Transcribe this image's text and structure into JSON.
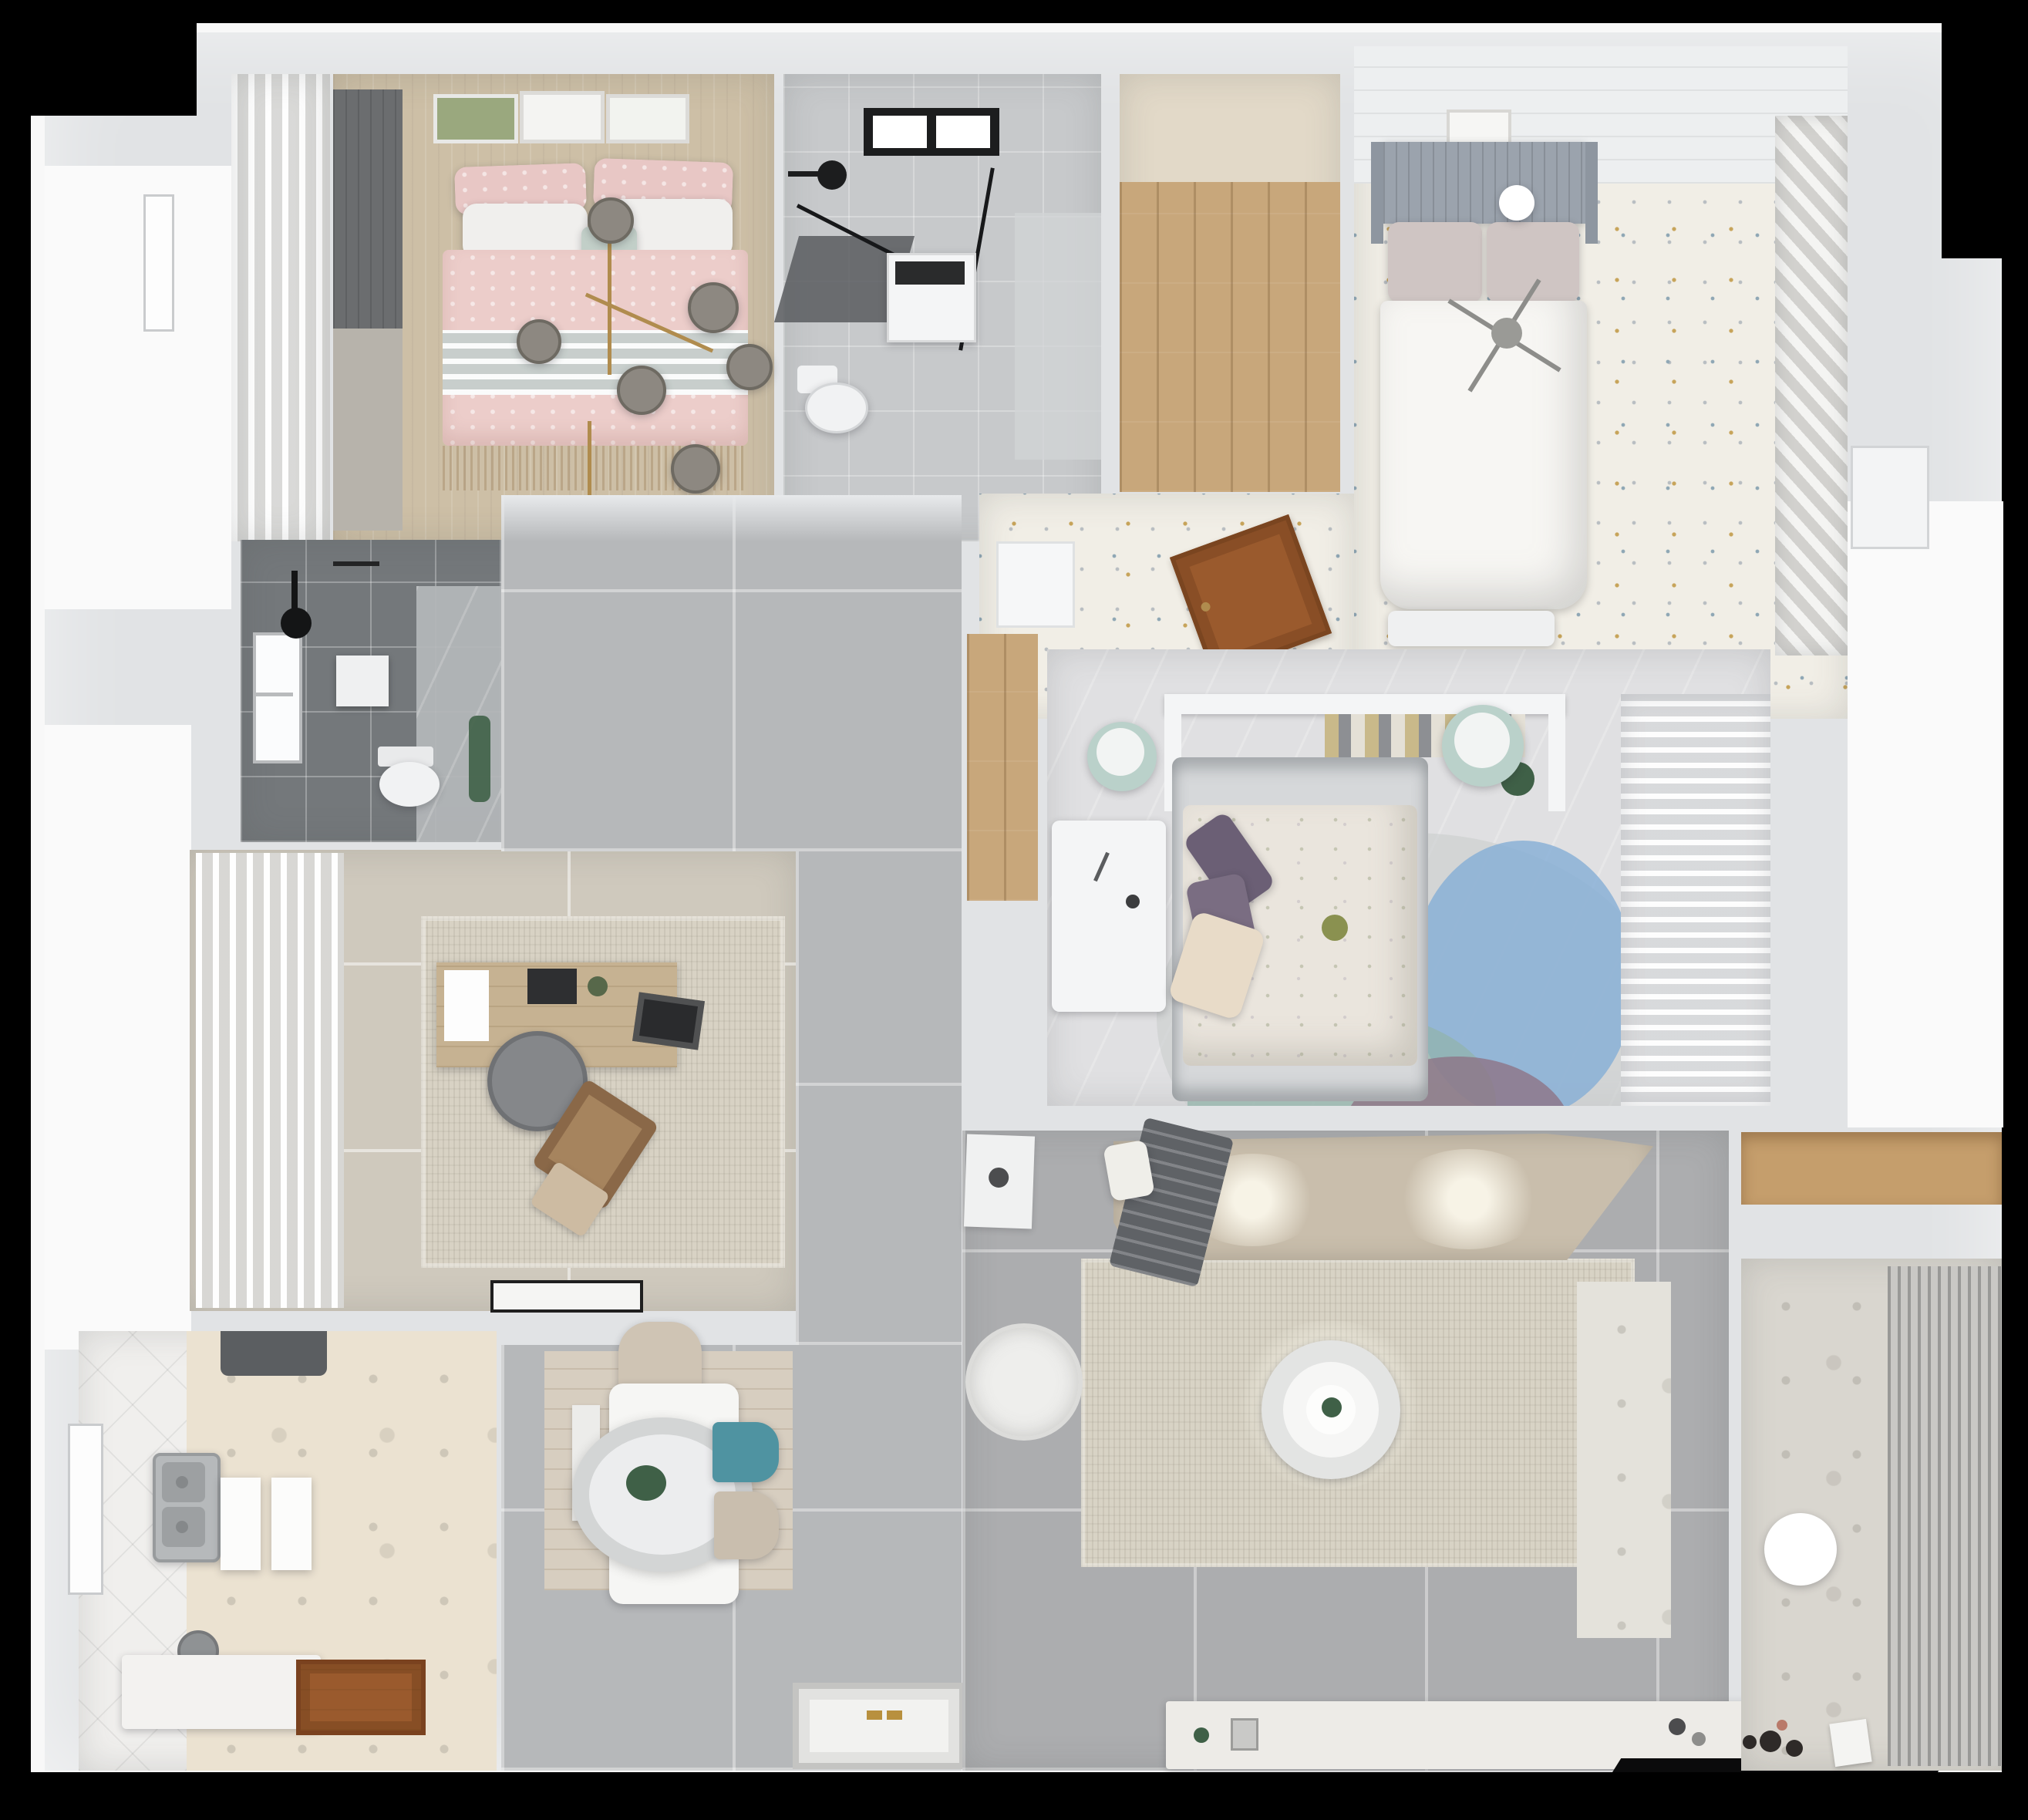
{
  "meta": {
    "type": "3d-floor-plan-render",
    "view": "top-down-apartment",
    "visible_text": "none"
  },
  "palette": {
    "background": "#000000",
    "canvas": "#f8f8f8",
    "wall": "#e1e3e5",
    "wall_dark": "#d2d4d6",
    "exterior_white": "#fafafa"
  },
  "rooms": {
    "bedroom2": {
      "name": "Bedroom with pink bed",
      "floor": "#cdbfa6"
    },
    "balcony_left": {
      "name": "Side ledge with curtains",
      "floor": "#e7e8e9"
    },
    "bathroom1": {
      "name": "Bathroom with glass shower",
      "floor": "#c7c9cb"
    },
    "closet": {
      "name": "Walk-through closet",
      "floor": "#c8a77b",
      "upper": "#e2d9c8"
    },
    "bedroom1": {
      "name": "Bedroom with white bed",
      "floor": "#f1eee6",
      "ceiling": "#edeff0",
      "wardrobe": "#e6e6e4"
    },
    "bathroom2": {
      "name": "Dark shower room",
      "floor": "#74787b",
      "marble": "#b5b8ba"
    },
    "study": {
      "name": "Study",
      "floor": "#cfc9bd",
      "curtain": "#e3e3e2"
    },
    "kitchen": {
      "name": "Kitchen / laundry",
      "floor": "#ebe2d1",
      "counter_zone": "#f0efed"
    },
    "hallway": {
      "name": "Hallway",
      "floor": "#b6b8ba"
    },
    "dining": {
      "name": "Dining area",
      "floor": "#b6b8ba",
      "wood_mat": "#d7cec0"
    },
    "master": {
      "name": "Master bedroom",
      "floor": "#e0e0e2",
      "nook_wood": "#c8a77b",
      "sheer": "#e4e5e7"
    },
    "living": {
      "name": "Living room",
      "floor": "#acadaf",
      "accent_strip": "#e4e2db"
    },
    "balcony": {
      "name": "Balcony with blinds",
      "floor": "#d9d6cf",
      "blinds": "#b5b4b1"
    },
    "storage": {
      "name": "Storage niche",
      "wood": "#c59e6c"
    }
  },
  "furniture": {
    "bed_pink_duvet": "#eccdca",
    "bed_pink_pillow": "#e8c7c5",
    "bed_white_pillow": "#f0efed",
    "bed_mint_band": "#c2cfc8",
    "chandelier_globe": "#8d8881",
    "chandelier_gold": "#b08c4e",
    "frame_art": "#9aa87e",
    "curtain_dark": "#6b6d6f",
    "shower_black": "#1c1d1e",
    "shower_tray": "#595c5f",
    "washer": "#f4f5f6",
    "toilet": "#f1f2f3",
    "headboard_gray": "#9ba3ad",
    "bed1_pillow": "#cfc5c3",
    "bed1_duvet": "#f7f6f3",
    "door_wood": "#9a5a2d",
    "plant_green": "#3f6047",
    "desk_wood": "#c6b292",
    "office_chair": "#85878a",
    "lounge_chair": "#8a6848",
    "monitor": "#2a2b2d",
    "rug_study": "#d8d2c4",
    "hood_dark": "#5b5e61",
    "sink_steel": "#b6b9bb",
    "kitchen_counter": "#f3f2f0",
    "dining_table": "#f6f6f4",
    "pendant_ring": "#d3d5d5",
    "chair_beige": "#cfc4b4",
    "chair_teal": "#4f93a1",
    "chair_beige2": "#c9beae",
    "entry_mat": "#f2f2f0",
    "mat_gold": "#b8903e",
    "master_mattress": "#d6d8da",
    "master_duvet": "#eae5dd",
    "pillow_purple": "#6b5f75",
    "pillow_purple2": "#7a6d82",
    "pillow_cream": "#e8dbc8",
    "pouf_mint": "#bad1ca",
    "shelf_white": "#f4f5f6",
    "rug_petal_base": "#c9cdcd",
    "rug_petal_blue": "#84aed6",
    "rug_petal_teal": "#92b3aa",
    "rug_petal_mauve": "#8d7486",
    "sofa_beige": "#c9beac",
    "blanket_gray": "#5f6266",
    "rug_living": "#d8d3c5",
    "coffee_table": "#e3e4e3",
    "armchair_white": "#eeeeec",
    "tv_console": "#edebe7",
    "tv_black": "#0b0b0c",
    "ball_lamp": "#ffffff",
    "toy_dark": "#2e2a28",
    "toy_pink": "#b97a6a"
  }
}
